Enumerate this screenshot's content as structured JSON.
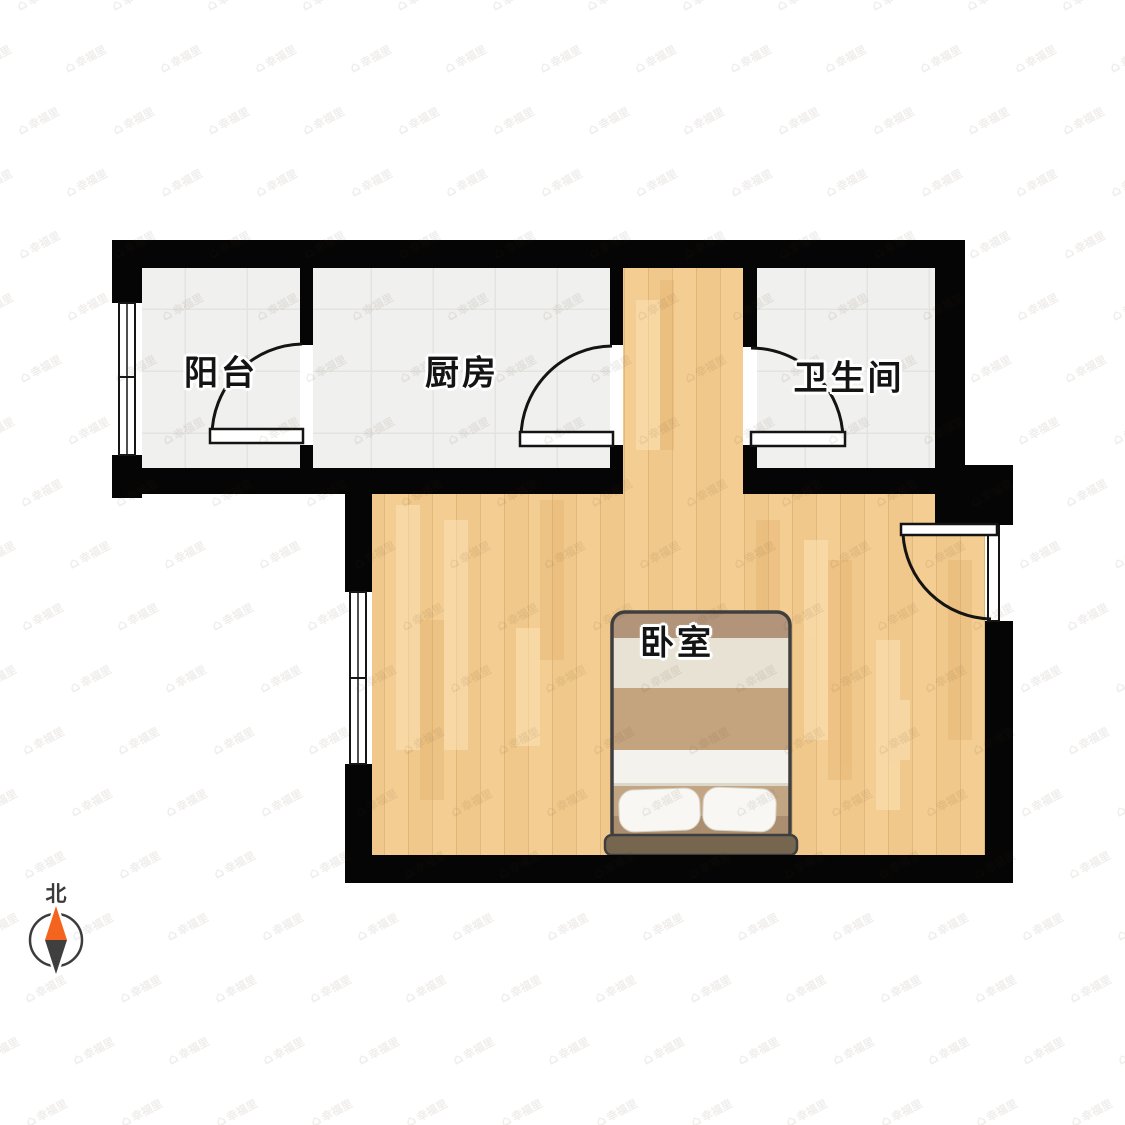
{
  "plan": {
    "rooms": [
      {
        "id": "balcony",
        "label": "阳台"
      },
      {
        "id": "kitchen",
        "label": "厨房"
      },
      {
        "id": "bathroom",
        "label": "卫生间"
      },
      {
        "id": "bedroom",
        "label": "卧室"
      }
    ],
    "furniture": [
      {
        "type": "double-bed",
        "room": "卧室"
      }
    ],
    "compass": {
      "north_label": "北"
    },
    "watermark": {
      "text": "幸福里"
    },
    "colors": {
      "wall": "#050505",
      "tile_floor": "#f0f0ee",
      "wood_floor": "#f0c88b",
      "bed_blanket_tan": "#c4a47f",
      "bed_blanket_cream": "#e7e2d4",
      "bed_headboard": "#77664f",
      "compass_north_orange": "#f4641e",
      "compass_south_gray": "#3f3f3f"
    }
  }
}
